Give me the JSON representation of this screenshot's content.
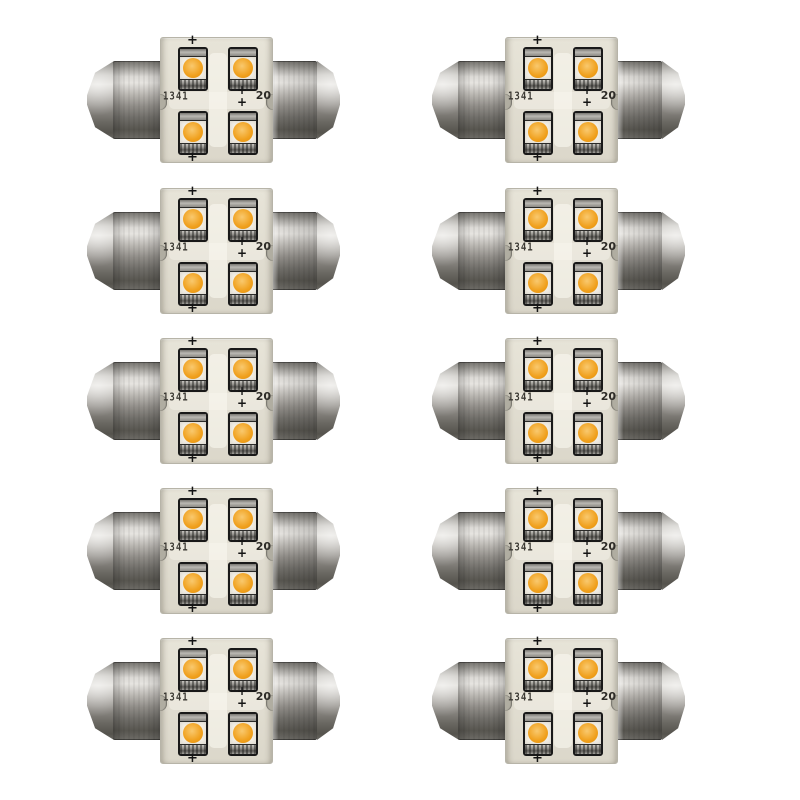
{
  "photo": {
    "background_color": "#ffffff",
    "items_count": 10,
    "grid": {
      "rows": 5,
      "columns": 2
    }
  },
  "bulb": {
    "marking_left": "1341",
    "marking_right": "20",
    "polarity_mark": "+",
    "led_count": 4,
    "colors": {
      "led_amber": "#f0a01d",
      "led_amber_light": "#f9c96e",
      "pcb": "#e7e4d8",
      "module_outline": "#191919",
      "cap_highlight": "#e6e4e0",
      "cap_shadow": "#585650"
    }
  }
}
